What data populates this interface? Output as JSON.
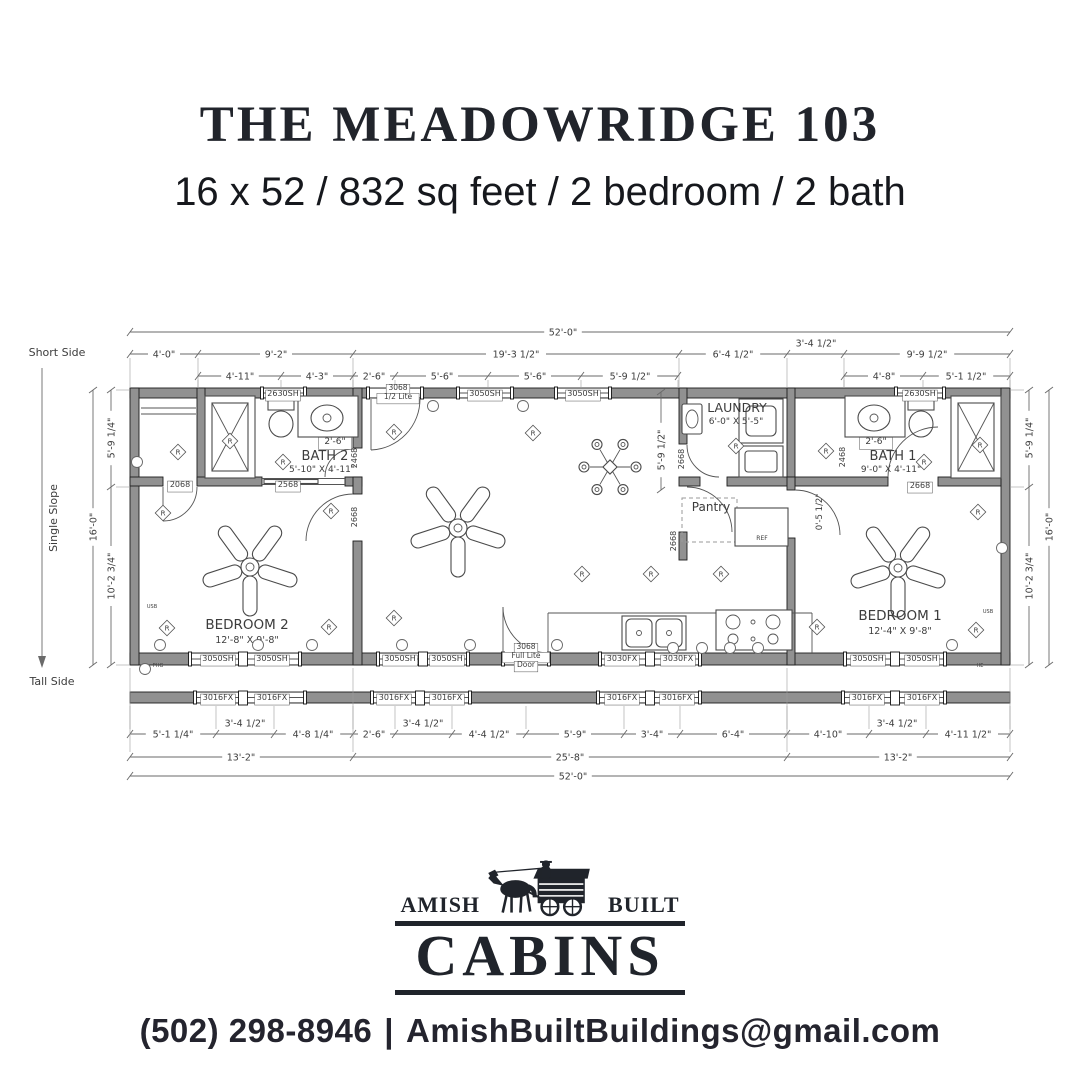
{
  "header": {
    "title": "THE MEADOWRIDGE 103",
    "subtitle": "16 x 52 / 832 sq feet / 2 bedroom / 2 bath"
  },
  "logo": {
    "left": "AMISH",
    "right": "BUILT",
    "main": "CABINS"
  },
  "contact": {
    "phone": "(502) 298-8946",
    "sep": "|",
    "email": "AmishBuiltBuildings@gmail.com"
  },
  "plan": {
    "dim_rows": [
      {
        "y": 332,
        "x1": 130,
        "x2": 1010,
        "ticks": [
          130,
          1010
        ],
        "labels": [
          {
            "t": "52'-0\"",
            "x": 563
          }
        ]
      },
      {
        "y": 354,
        "x1": 130,
        "x2": 1010,
        "ticks": [
          130,
          198,
          353,
          679,
          787,
          844,
          1010
        ],
        "ext": [
          358,
          388
        ],
        "labels": [
          {
            "t": "4'-0\"",
            "x": 164
          },
          {
            "t": "9'-2\"",
            "x": 276
          },
          {
            "t": "19'-3 1/2\"",
            "x": 516
          },
          {
            "t": "6'-4 1/2\"",
            "x": 733
          },
          {
            "t": "3'-4 1/2\"",
            "x": 816,
            "dy": -11
          },
          {
            "t": "9'-9 1/2\"",
            "x": 927
          }
        ]
      },
      {
        "y": 376,
        "x1": 198,
        "x2": 678,
        "ticks": [
          198,
          281,
          353,
          395,
          488,
          581,
          678
        ],
        "ext": [
          380,
          388
        ],
        "labels": [
          {
            "t": "4'-11\"",
            "x": 240
          },
          {
            "t": "4'-3\"",
            "x": 317
          },
          {
            "t": "2'-6\"",
            "x": 374
          },
          {
            "t": "5'-6\"",
            "x": 442
          },
          {
            "t": "5'-6\"",
            "x": 535
          },
          {
            "t": "5'-9 1/2\"",
            "x": 630
          }
        ]
      },
      {
        "y": 376,
        "x1": 844,
        "x2": 1010,
        "ticks": [
          844,
          923,
          1010
        ],
        "ext": [
          380,
          388
        ],
        "labels": [
          {
            "t": "4'-8\"",
            "x": 884
          },
          {
            "t": "5'-1 1/2\"",
            "x": 966
          }
        ]
      },
      {
        "y": 734,
        "x1": 130,
        "x2": 1010,
        "ticks": [
          130,
          216,
          274,
          353,
          395,
          452,
          526,
          624,
          680,
          787,
          869,
          926,
          1010
        ],
        "ext": [
          706,
          729
        ],
        "labels": [
          {
            "t": "5'-1 1/4\"",
            "x": 173
          },
          {
            "t": "3'-4 1/2\"",
            "x": 245,
            "dy": -11
          },
          {
            "t": "4'-8 1/4\"",
            "x": 313
          },
          {
            "t": "2'-6\"",
            "x": 374
          },
          {
            "t": "3'-4 1/2\"",
            "x": 423,
            "dy": -11
          },
          {
            "t": "4'-4 1/2\"",
            "x": 489
          },
          {
            "t": "5'-9\"",
            "x": 575
          },
          {
            "t": "3'-4\"",
            "x": 652
          },
          {
            "t": "6'-4\"",
            "x": 733
          },
          {
            "t": "4'-10\"",
            "x": 828
          },
          {
            "t": "3'-4 1/2\"",
            "x": 897,
            "dy": -11
          },
          {
            "t": "4'-11 1/2\"",
            "x": 968
          }
        ]
      },
      {
        "y": 757,
        "x1": 130,
        "x2": 1010,
        "ticks": [
          130,
          353,
          787,
          1010
        ],
        "ext": [
          668,
          752
        ],
        "labels": [
          {
            "t": "13'-2\"",
            "x": 241
          },
          {
            "t": "25'-8\"",
            "x": 570
          },
          {
            "t": "13'-2\"",
            "x": 898
          }
        ]
      },
      {
        "y": 776,
        "x1": 130,
        "x2": 1010,
        "ticks": [
          130,
          1010
        ],
        "labels": [
          {
            "t": "52'-0\"",
            "x": 573
          }
        ]
      }
    ],
    "dim_cols": [
      {
        "x": 93,
        "y1": 390,
        "y2": 665,
        "ticks": [
          390,
          665
        ],
        "labels": [
          {
            "t": "16'-0\"",
            "y": 527
          }
        ]
      },
      {
        "x": 111,
        "y1": 390,
        "y2": 665,
        "ticks": [
          390,
          487,
          665
        ],
        "ext": [
          116,
          130
        ],
        "labels": [
          {
            "t": "5'-9 1/4\"",
            "y": 438
          },
          {
            "t": "10'-2 3/4\"",
            "y": 576
          }
        ]
      },
      {
        "x": 1029,
        "y1": 390,
        "y2": 665,
        "ticks": [
          390,
          487,
          665
        ],
        "ext": [
          1010,
          1024
        ],
        "labels": [
          {
            "t": "5'-9 1/4\"",
            "y": 438
          },
          {
            "t": "10'-2 3/4\"",
            "y": 576
          }
        ]
      },
      {
        "x": 1049,
        "y1": 390,
        "y2": 665,
        "ticks": [
          390,
          665
        ],
        "labels": [
          {
            "t": "16'-0\"",
            "y": 527
          }
        ]
      },
      {
        "x": 661,
        "y1": 392,
        "y2": 490,
        "ticks": [
          392,
          490
        ],
        "labels": [
          {
            "t": "5'-9 1/2\"",
            "y": 450
          }
        ]
      }
    ],
    "labels": [
      {
        "t": "Short Side",
        "x": 57,
        "y": 356,
        "s": 11
      },
      {
        "t": "Single Slope",
        "x": 57,
        "y": 518,
        "s": 11,
        "r": -90
      },
      {
        "t": "Tall Side",
        "x": 52,
        "y": 685,
        "s": 11
      },
      {
        "t": "2630SH",
        "x": 283,
        "y": 396,
        "s": 8,
        "bg": 1
      },
      {
        "t": "3068",
        "x": 398,
        "y": 390,
        "s": 7.5,
        "bg": 1
      },
      {
        "t": "1/2 Lite",
        "x": 398,
        "y": 399,
        "s": 7.5,
        "bg": 1
      },
      {
        "t": "3050SH",
        "x": 485,
        "y": 396,
        "s": 8,
        "bg": 1
      },
      {
        "t": "3050SH",
        "x": 583,
        "y": 396,
        "s": 8,
        "bg": 1
      },
      {
        "t": "2630SH",
        "x": 920,
        "y": 396,
        "s": 8,
        "bg": 1
      },
      {
        "t": "3050SH",
        "x": 218,
        "y": 661,
        "s": 8,
        "bg": 1
      },
      {
        "t": "3050SH",
        "x": 272,
        "y": 661,
        "s": 8,
        "bg": 1
      },
      {
        "t": "3050SH",
        "x": 400,
        "y": 661,
        "s": 8,
        "bg": 1
      },
      {
        "t": "3050SH",
        "x": 447,
        "y": 661,
        "s": 8,
        "bg": 1
      },
      {
        "t": "3068",
        "x": 526,
        "y": 649,
        "s": 7.5,
        "bg": 1
      },
      {
        "t": "Full Lite",
        "x": 526,
        "y": 658,
        "s": 7.5,
        "bg": 1
      },
      {
        "t": "Door",
        "x": 526,
        "y": 667,
        "s": 7.5,
        "bg": 1
      },
      {
        "t": "3030FX",
        "x": 622,
        "y": 661,
        "s": 8,
        "bg": 1
      },
      {
        "t": "3030FX",
        "x": 678,
        "y": 661,
        "s": 8,
        "bg": 1
      },
      {
        "t": "3050SH",
        "x": 868,
        "y": 661,
        "s": 8,
        "bg": 1
      },
      {
        "t": "3050SH",
        "x": 922,
        "y": 661,
        "s": 8,
        "bg": 1
      },
      {
        "t": "3016FX",
        "x": 218,
        "y": 700,
        "s": 8,
        "bg": 1
      },
      {
        "t": "3016FX",
        "x": 272,
        "y": 700,
        "s": 8,
        "bg": 1
      },
      {
        "t": "3016FX",
        "x": 394,
        "y": 700,
        "s": 8,
        "bg": 1
      },
      {
        "t": "3016FX",
        "x": 447,
        "y": 700,
        "s": 8,
        "bg": 1
      },
      {
        "t": "3016FX",
        "x": 622,
        "y": 700,
        "s": 8,
        "bg": 1
      },
      {
        "t": "3016FX",
        "x": 677,
        "y": 700,
        "s": 8,
        "bg": 1
      },
      {
        "t": "3016FX",
        "x": 867,
        "y": 700,
        "s": 8,
        "bg": 1
      },
      {
        "t": "3016FX",
        "x": 922,
        "y": 700,
        "s": 8,
        "bg": 1
      },
      {
        "t": "2068",
        "x": 180,
        "y": 487,
        "s": 8,
        "bg": 1
      },
      {
        "t": "2568",
        "x": 288,
        "y": 487,
        "s": 8,
        "bg": 1
      },
      {
        "t": "2468",
        "x": 357,
        "y": 458,
        "s": 8,
        "r": -90
      },
      {
        "t": "2668",
        "x": 357,
        "y": 517,
        "s": 8,
        "r": -90
      },
      {
        "t": "2668",
        "x": 684,
        "y": 459,
        "s": 8,
        "r": -90
      },
      {
        "t": "2668",
        "x": 676,
        "y": 541,
        "s": 8,
        "r": -90
      },
      {
        "t": "2468",
        "x": 845,
        "y": 457,
        "s": 8,
        "r": -90
      },
      {
        "t": "2668",
        "x": 920,
        "y": 488,
        "s": 8,
        "bg": 1
      },
      {
        "t": "BATH 2",
        "x": 325,
        "y": 460,
        "s": 13
      },
      {
        "t": "5'-10\" X 4'-11\"",
        "x": 322,
        "y": 472,
        "s": 9
      },
      {
        "t": "BATH 1",
        "x": 893,
        "y": 460,
        "s": 13
      },
      {
        "t": "9'-0\" X 4'-11\"",
        "x": 891,
        "y": 472,
        "s": 9
      },
      {
        "t": "LAUNDRY",
        "x": 737,
        "y": 412,
        "s": 12.5
      },
      {
        "t": "6'-0\" X 5'-5\"",
        "x": 736,
        "y": 424,
        "s": 9
      },
      {
        "t": "Pantry",
        "x": 711,
        "y": 511,
        "s": 12
      },
      {
        "t": "REF",
        "x": 762,
        "y": 540,
        "s": 6
      },
      {
        "t": "BEDROOM 2",
        "x": 247,
        "y": 629,
        "s": 13.5
      },
      {
        "t": "12'-8\" X 9'-8\"",
        "x": 247,
        "y": 643,
        "s": 9.5
      },
      {
        "t": "BEDROOM 1",
        "x": 900,
        "y": 620,
        "s": 13.5
      },
      {
        "t": "12'-4\" X 9'-8\"",
        "x": 900,
        "y": 634,
        "s": 9.5
      },
      {
        "t": "2'-6\"",
        "x": 335,
        "y": 444,
        "s": 9,
        "bg": 1
      },
      {
        "t": "2'-6\"",
        "x": 876,
        "y": 444,
        "s": 9,
        "bg": 1
      },
      {
        "t": "0'-5 1/2\"",
        "x": 822,
        "y": 512,
        "s": 8.5,
        "r": -90
      },
      {
        "t": "USB",
        "x": 152,
        "y": 608,
        "s": 5
      },
      {
        "t": "USB",
        "x": 988,
        "y": 613,
        "s": 5
      },
      {
        "t": "PHG",
        "x": 158,
        "y": 667,
        "s": 5
      },
      {
        "t": "HE",
        "x": 980,
        "y": 667,
        "s": 5
      }
    ],
    "outlets": [
      [
        178,
        452
      ],
      [
        230,
        441
      ],
      [
        283,
        462
      ],
      [
        163,
        513
      ],
      [
        167,
        628
      ],
      [
        329,
        627
      ],
      [
        331,
        511
      ],
      [
        394,
        432
      ],
      [
        533,
        433
      ],
      [
        582,
        574
      ],
      [
        651,
        574
      ],
      [
        721,
        574
      ],
      [
        736,
        446
      ],
      [
        826,
        451
      ],
      [
        924,
        462
      ],
      [
        978,
        512
      ],
      [
        817,
        627
      ],
      [
        976,
        630
      ],
      [
        980,
        445
      ],
      [
        394,
        618
      ]
    ],
    "circles": [
      [
        312,
        645
      ],
      [
        402,
        645
      ],
      [
        470,
        645
      ],
      [
        557,
        645
      ],
      [
        673,
        648
      ],
      [
        702,
        648
      ],
      [
        730,
        648
      ],
      [
        758,
        648
      ],
      [
        952,
        645
      ],
      [
        160,
        645
      ],
      [
        258,
        645
      ],
      [
        137,
        462
      ],
      [
        1002,
        548
      ],
      [
        433,
        406
      ],
      [
        523,
        406
      ],
      [
        145,
        669
      ]
    ]
  }
}
